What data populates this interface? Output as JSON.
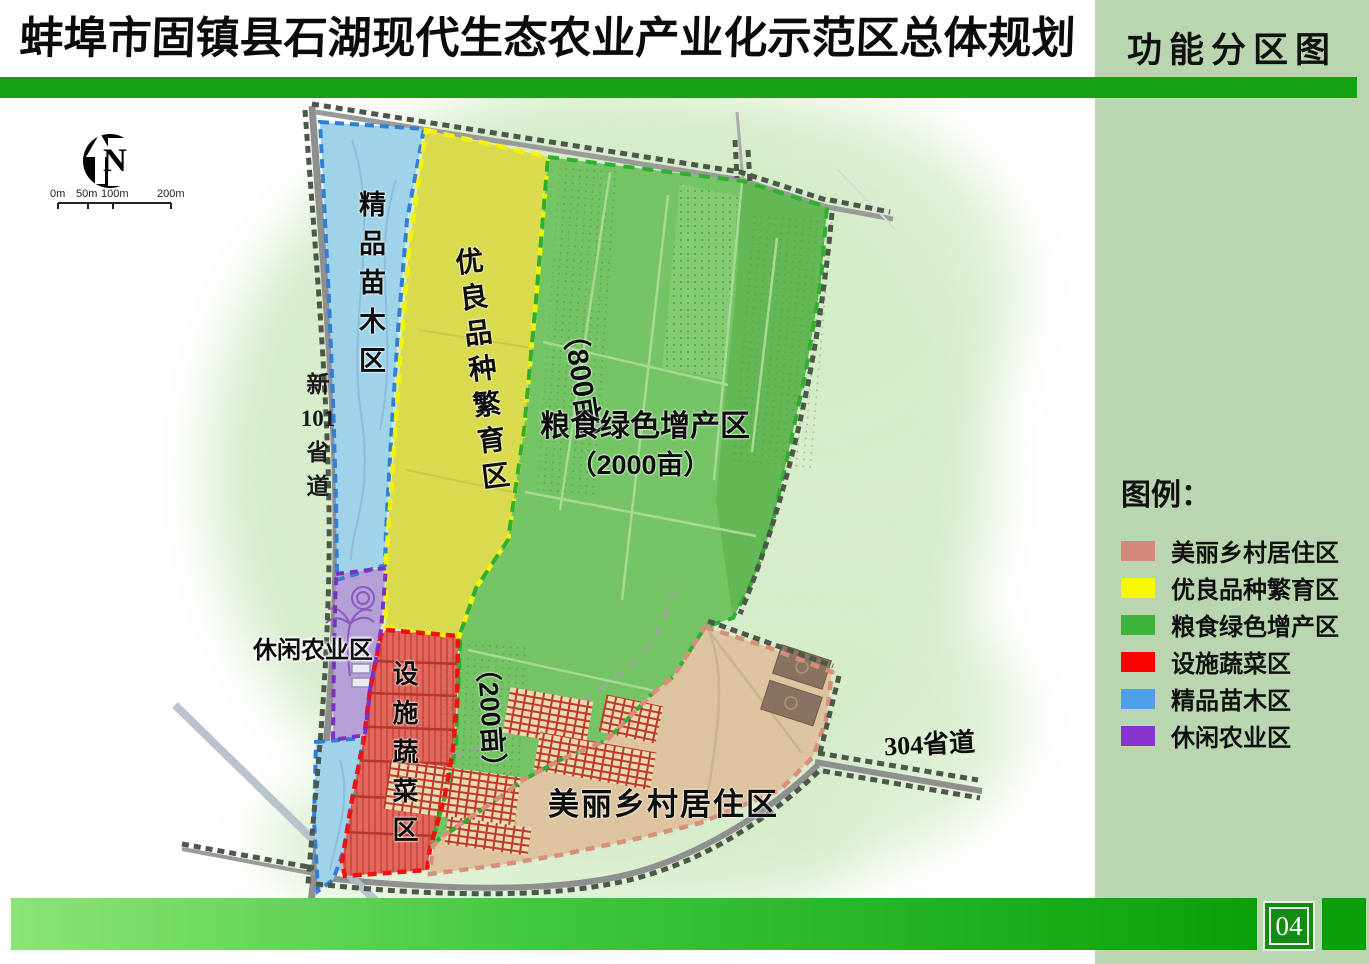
{
  "header": {
    "title": "蚌埠市固镇县石湖现代生态农业产业化示范区总体规划",
    "subtitle": "功能分区图"
  },
  "legend": {
    "title": "图例：",
    "items": [
      {
        "label": "美丽乡村居住区",
        "color": "#d4897a"
      },
      {
        "label": "优良品种繁育区",
        "color": "#f8f800"
      },
      {
        "label": "粮食绿色增产区",
        "color": "#3cb43c"
      },
      {
        "label": "设施蔬菜区",
        "color": "#f80400"
      },
      {
        "label": "精品苗木区",
        "color": "#4f9fe8"
      },
      {
        "label": "休闲农业区",
        "color": "#8833cc"
      }
    ]
  },
  "map": {
    "zones": {
      "nursery": {
        "label": "精品苗木区",
        "color": "#9fd3ea"
      },
      "seed": {
        "label": "优良品种繁育区",
        "area_label": "（800亩）",
        "color": "#d9da4e"
      },
      "grain": {
        "label": "粮食绿色增产区",
        "area_label": "（2000亩）",
        "color": "#74c465"
      },
      "vegetable": {
        "label": "设施蔬菜区",
        "area_label": "（200亩）",
        "color": "#e2675d"
      },
      "leisure": {
        "label": "休闲农业区",
        "color": "#b49fd6"
      },
      "village": {
        "label": "美丽乡村居住区",
        "color": "#ddc49e"
      }
    },
    "roads": {
      "new101": {
        "chars": [
          "新",
          "101",
          "省",
          "道"
        ]
      },
      "s304": {
        "label": "304省道"
      }
    },
    "north_label": "N",
    "scale_bar": {
      "labels": [
        "0m",
        "50m",
        "100m",
        "200m"
      ]
    }
  },
  "footer": {
    "page_number": "04"
  }
}
